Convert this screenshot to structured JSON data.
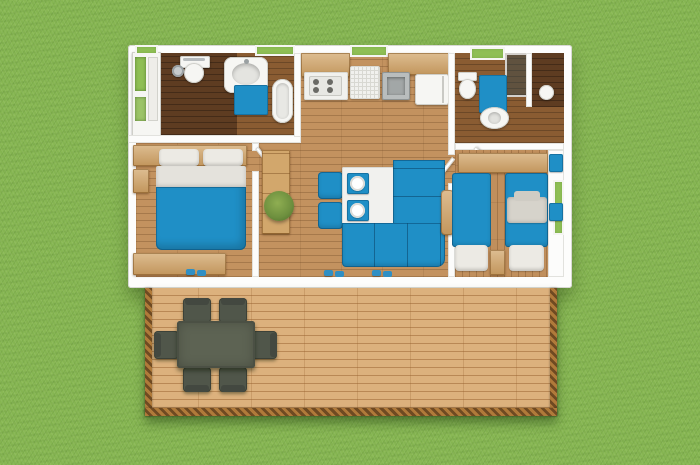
{
  "scene": {
    "description": "3D top-down architectural render of a two-bedroom mobile home with a front wooden deck, placed on grass",
    "house_label": "Mobile home floor plan",
    "deck_label": "Wooden deck terrace"
  },
  "palette": {
    "grass": "#85b551",
    "wall_white": "#fdfdfc",
    "floor_wood": "#c3925f",
    "floor_dark_wood": "#5e3c21",
    "deck_wood": "#dcb17d",
    "rope_border": "#6f4a22",
    "accent_blue": "#1f8fc6",
    "cabinet_wood": "#d2a76c",
    "counter_white": "#f1f1ee",
    "patio_furniture": "#50564a",
    "patio_table": "#5d6353",
    "plant_green": "#6d8f3e",
    "linen_white": "#eceae4",
    "steel": "#b9bdbd",
    "glass_shower": "rgba(45,70,80,0.45)"
  },
  "rooms": [
    {
      "id": "closet",
      "label": "Storage closet with shelves"
    },
    {
      "id": "bathroom-1",
      "label": "Bathroom: shower, toilet, washbasin, bathtub"
    },
    {
      "id": "kitchen",
      "label": "Kitchen: hob, drainer, sink, fridge, cabinets"
    },
    {
      "id": "bathroom-2",
      "label": "Second bathroom: glass shower, toilet, pedestal basin, WC"
    },
    {
      "id": "bedroom-master",
      "label": "Master bedroom with double bed"
    },
    {
      "id": "living-room",
      "label": "Living / dining room with corner sofa and table"
    },
    {
      "id": "bedroom-twin",
      "label": "Twin bedroom with two single beds"
    },
    {
      "id": "deck",
      "label": "Wooden deck with outdoor dining table and six chairs"
    }
  ],
  "furniture": {
    "bedroom_master": [
      "headboard shelf",
      "double bed with blue duvet",
      "two white pillows",
      "storage bench",
      "blue slippers"
    ],
    "living_room": [
      "tall wooden cabinet",
      "green plant",
      "white dining table with two place settings",
      "two blue chairs",
      "blue corner sofa",
      "wooden armrest",
      "blue slippers"
    ],
    "kitchen": [
      "upper cabinets",
      "four-burner hob",
      "draining rack",
      "stainless sink",
      "fridge",
      "window over worktop"
    ],
    "bathroom_1": [
      "toilet with cistern",
      "shower head",
      "vanity washbasin",
      "blue bath mat",
      "bathtub"
    ],
    "bathroom_2": [
      "skylight window",
      "glass shower screen",
      "toilet",
      "blue bath mat",
      "pedestal washbasin",
      "small WC fixture"
    ],
    "bedroom_twin": [
      "wall shelf",
      "two single beds with blue duvets",
      "white pillows",
      "grey shirt on bed",
      "nightstand",
      "blue towels",
      "window"
    ],
    "deck": [
      "dark grey dining table",
      "six dark grey chairs",
      "rope edge border"
    ]
  }
}
